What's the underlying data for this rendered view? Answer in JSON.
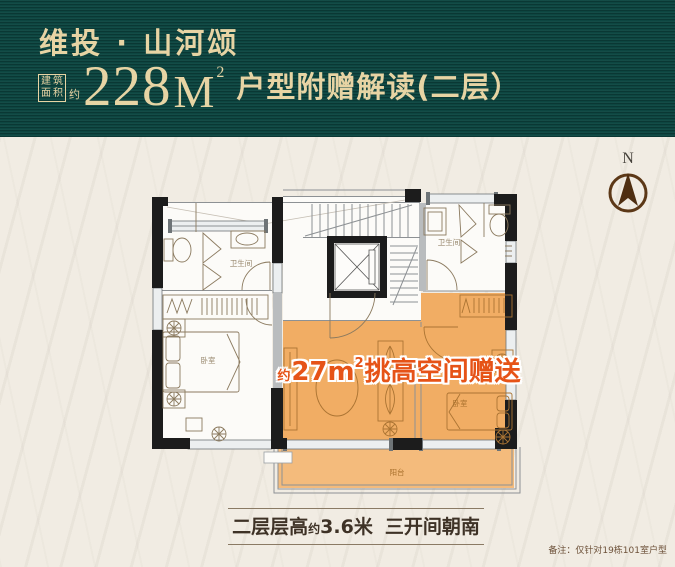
{
  "header": {
    "brand": "维投 · 山河颂",
    "area_box_chars": [
      "建",
      "筑",
      "面",
      "积"
    ],
    "area_approx": "约",
    "area_value": "228",
    "area_unit": "M",
    "area_sup": "2",
    "subtitle": "户型附赠解读(二层）",
    "bg_color": "#0d4641",
    "text_color": "#e7d4a4"
  },
  "compass": {
    "label": "N"
  },
  "floorplan": {
    "labels": {
      "bath_left": "卫生间",
      "bath_right": "卫生间",
      "bed_left": "卧室",
      "bed_right": "卧室",
      "balcony": "阳台"
    },
    "highlight": {
      "prefix": "约",
      "value": "27",
      "unit": "m",
      "sup": "2",
      "suffix": "挑高空间赠送",
      "text_color": "#e65317",
      "area_fill": "#f1ad64",
      "balcony_fill": "#f4bb7c"
    }
  },
  "footer": {
    "caption_p1": "二层层高",
    "caption_approx": "约",
    "caption_p2": "3.6米",
    "caption_p3": "三开间朝南",
    "note": "备注：仅针对19栋101室户型"
  }
}
